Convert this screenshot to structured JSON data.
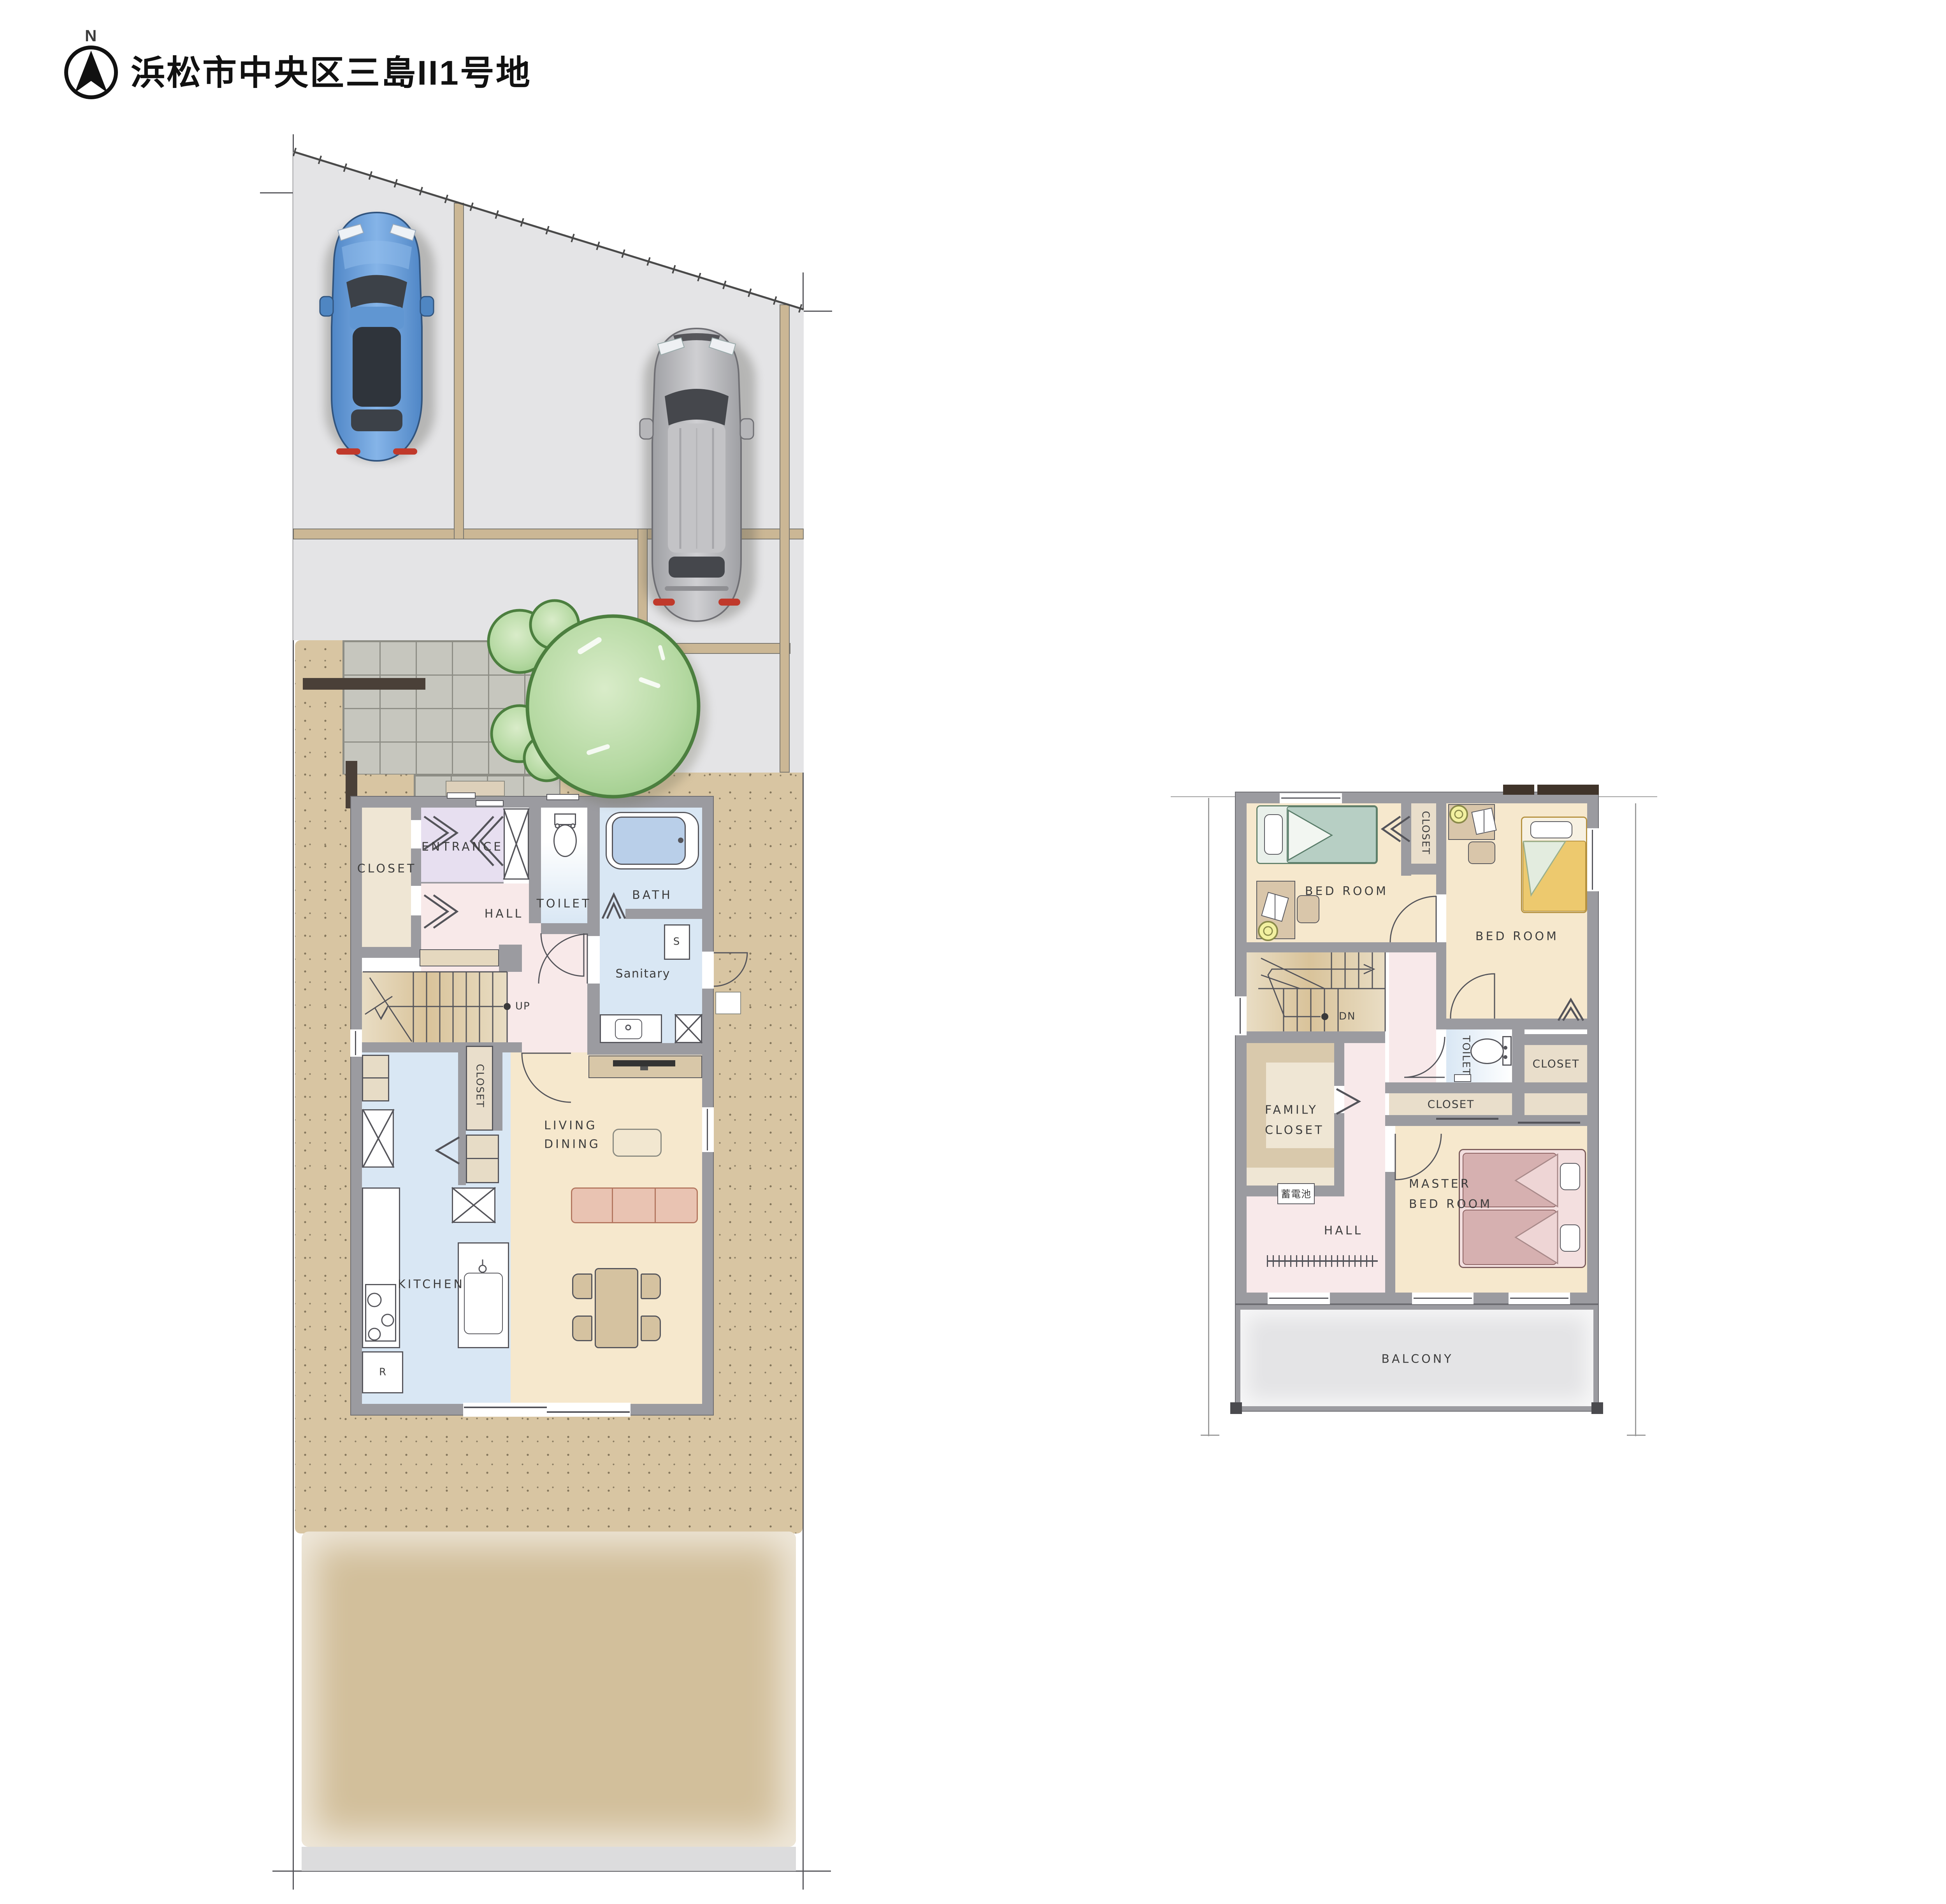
{
  "header": {
    "north_label": "N",
    "title": "浜松市中央区三島II1号地"
  },
  "palette": {
    "wall": "#9b9ba0",
    "parking": "#e4e4e6",
    "parcel_line": "#cbb795",
    "ground_dotted": "#d8c5a2",
    "garden": "#d2bf9b",
    "road_strip": "#dcdcdd",
    "tile": "#c6c6be",
    "tree_fill": "#b5d9a2",
    "tree_stroke": "#4c7f3f",
    "fence": "#4a4038",
    "car_blue": "#5f97d8",
    "car_gray": "#b4b4b7",
    "entrance": "#e7dff0",
    "hall_pink": "#f8e9e9",
    "water_blue": "#d9e7f4",
    "living_cream": "#f6e8cd",
    "closet_tan": "#ece3d1",
    "stairs_tan": "#d9c39a",
    "bed_teal": "#b7cfc4",
    "bed_yellow": "#edc96e",
    "bed_pink": "#d6b0b0",
    "sofa": "#e9c3b2",
    "balcony": "#e4e4e6",
    "label_text": "#3d3d3d"
  },
  "floor1": {
    "labels": {
      "closet": "CLOSET",
      "entrance": "ENTRANCE",
      "toilet": "TOILET",
      "bath": "BATH",
      "hall": "HALL",
      "sanitary": "Sanitary",
      "storage": "S",
      "up": "UP",
      "pantry": "CLOSET",
      "living1": "LIVING",
      "living2": "DINING",
      "kitchen": "KITCHEN",
      "fridge": "R"
    }
  },
  "floor2": {
    "labels": {
      "bedroom1": "BED ROOM",
      "bedroom2": "BED ROOM",
      "closet_top": "CLOSET",
      "dn": "DN",
      "toilet": "TOILET",
      "closet_side": "CLOSET",
      "closet_mid": "CLOSET",
      "family1": "FAMILY",
      "family2": "CLOSET",
      "battery": "蓄電池",
      "master1": "MASTER",
      "master2": "BED ROOM",
      "hall": "HALL",
      "balcony": "BALCONY"
    }
  }
}
